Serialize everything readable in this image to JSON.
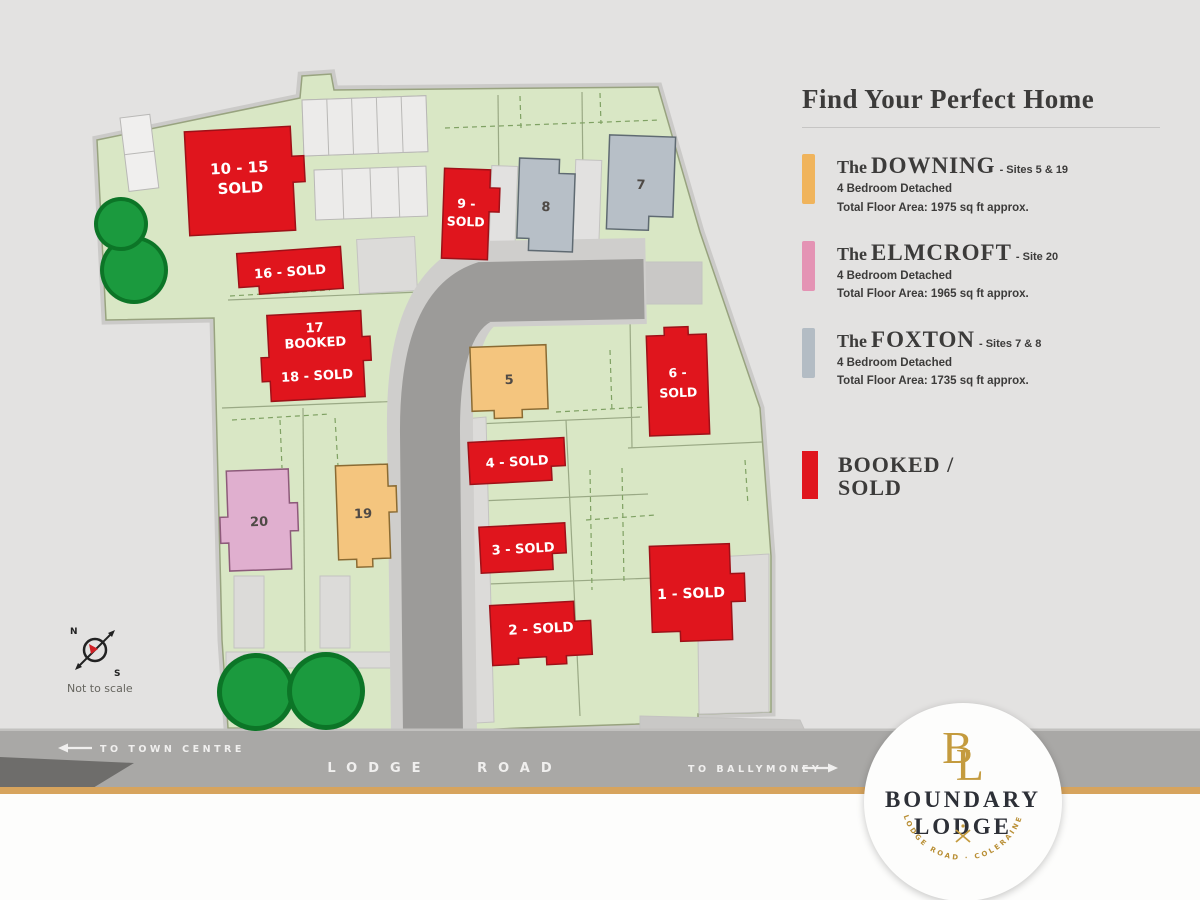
{
  "legend": {
    "title": "Find Your Perfect Home",
    "items": [
      {
        "prefix": "The",
        "name": "DOWNING",
        "suffix": "- Sites 5 & 19",
        "detail": "4 Bedroom Detached",
        "area": "Total Floor Area: 1975 sq ft approx.",
        "color": "#f0b45c"
      },
      {
        "prefix": "The",
        "name": "ELMCROFT",
        "suffix": "- Site 20",
        "detail": "4 Bedroom Detached",
        "area": "Total Floor Area: 1965 sq ft approx.",
        "color": "#e493b4"
      },
      {
        "prefix": "The",
        "name": "FOXTON",
        "suffix": "- Sites 7 & 8",
        "detail": "4 Bedroom Detached",
        "area": "Total Floor Area: 1735 sq ft approx.",
        "color": "#b3bcc4"
      }
    ],
    "status": {
      "line1": "BOOKED /",
      "line2": "SOLD",
      "color": "#e0151d"
    }
  },
  "map": {
    "plots": [
      {
        "id": "10-15",
        "color": "#e0151d",
        "lines": [
          "10 - 15",
          "SOLD"
        ]
      },
      {
        "id": "16",
        "color": "#e0151d",
        "lines": [
          "16 - SOLD"
        ]
      },
      {
        "id": "17",
        "color": "#e0151d",
        "lines": [
          "17",
          "BOOKED"
        ]
      },
      {
        "id": "18",
        "color": "#e0151d",
        "lines": [
          "18 - SOLD"
        ]
      },
      {
        "id": "20",
        "color": "#e0afcf",
        "lines": [
          "20"
        ]
      },
      {
        "id": "19",
        "color": "#f4c57e",
        "lines": [
          "19"
        ]
      },
      {
        "id": "9",
        "color": "#e0151d",
        "lines": [
          "9 -",
          "SOLD"
        ]
      },
      {
        "id": "8",
        "color": "#b7bfc7",
        "lines": [
          "8"
        ]
      },
      {
        "id": "7",
        "color": "#b7bfc7",
        "lines": [
          "7"
        ]
      },
      {
        "id": "5",
        "color": "#f4c57e",
        "lines": [
          "5"
        ]
      },
      {
        "id": "6",
        "color": "#e0151d",
        "lines": [
          "6 -",
          "SOLD"
        ]
      },
      {
        "id": "4",
        "color": "#e0151d",
        "lines": [
          "4 - SOLD"
        ]
      },
      {
        "id": "3",
        "color": "#e0151d",
        "lines": [
          "3 - SOLD"
        ]
      },
      {
        "id": "2",
        "color": "#e0151d",
        "lines": [
          "2 - SOLD"
        ]
      },
      {
        "id": "1",
        "color": "#e0151d",
        "lines": [
          "1 - SOLD"
        ]
      }
    ],
    "road_name": "LODGE ROAD",
    "to_town_centre": "TO TOWN CENTRE",
    "to_ballymoney": "TO BALLYMONEY",
    "not_to_scale": "Not to scale",
    "compass": {
      "north": "N",
      "south": "S"
    }
  },
  "logo": {
    "monogram_b": "B",
    "monogram_l": "L",
    "name_line1": "BOUNDARY",
    "name_line2": "LODGE",
    "tagline": "LODGE ROAD  ·  COLERAINE"
  },
  "colors": {
    "background": "#e3e2e1",
    "site_green": "#d9e7c5",
    "road_dark": "#9c9b99",
    "road_band": "#a9a8a6",
    "footpath": "#cfcecc",
    "sold_red": "#e0151d",
    "downing_orange": "#f4c57e",
    "elmcroft_pink": "#e0afcf",
    "foxton_grey": "#b7bfc7",
    "tree_green": "#1b9a3e",
    "gold_stripe": "#d7a45d",
    "text_dark": "#3c3b3a",
    "logo_gold": "#bf953f"
  }
}
